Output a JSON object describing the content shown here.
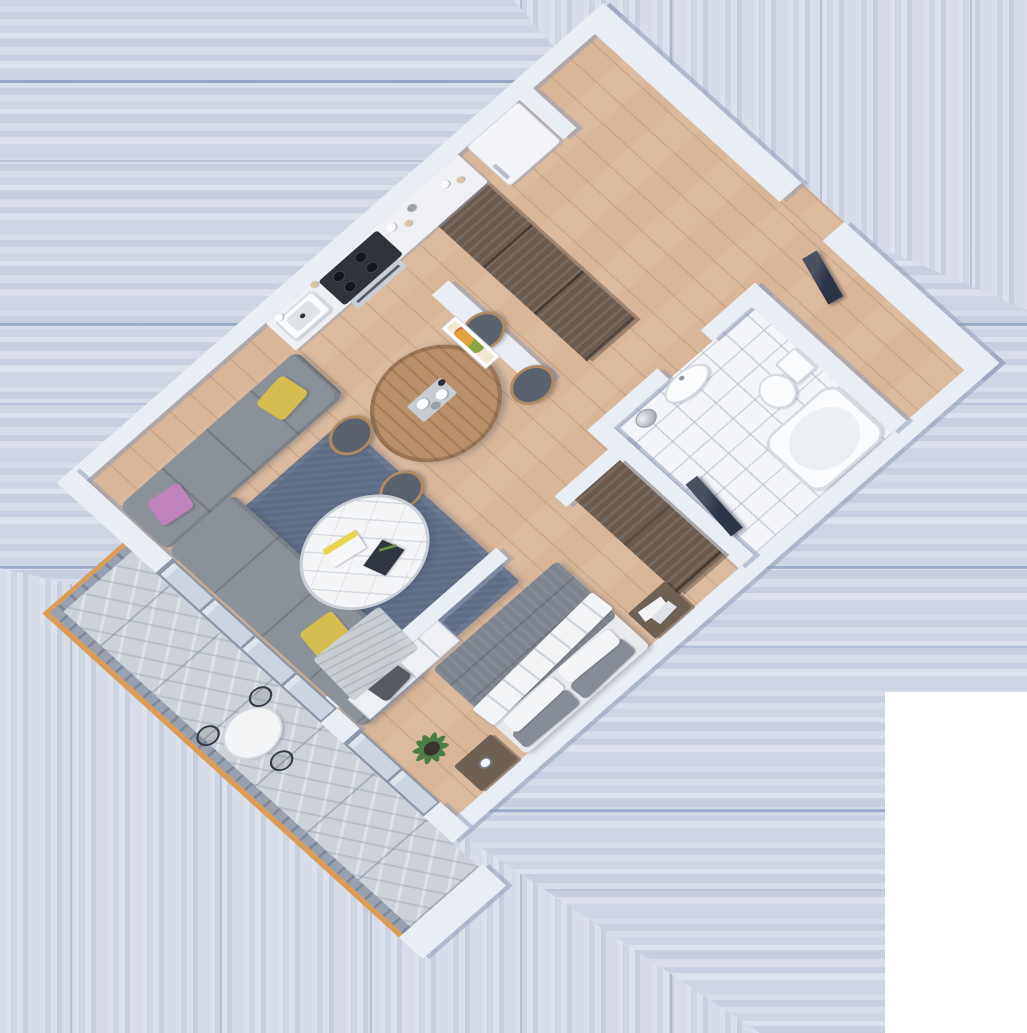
{
  "scene": {
    "label": "3D isometric floor-plan rendering of a one-bedroom apartment with balcony",
    "projection": "isometric render, rotated about 40 degrees",
    "background": "horizontal and vertical pale blue-gray stripe artifact with white bottom-right corner block",
    "visible_text": ""
  },
  "rooms": {
    "kitchen": {
      "label": "Kitchen",
      "items": [
        "counter with sink",
        "gas cooktop",
        "oven front",
        "open shelves with dishes and bottles",
        "white refrigerator with handle",
        "wall niche stub"
      ]
    },
    "dining": {
      "label": "Dining area",
      "items": [
        "oval wooden dining table",
        "4 wood chairs with dark gray cushions",
        "gray table runner with plates and dark bottle",
        "framed colorful artwork on partition wall"
      ]
    },
    "living": {
      "label": "Living room",
      "items": [
        "L-shaped gray sofa",
        "2 yellow pillows",
        "pink pillow",
        "dark gray pillow",
        "white throw blanket",
        "blue-gray area rug",
        "round white marble coffee table",
        "2 magazines",
        "green sprig"
      ]
    },
    "hallway": {
      "label": "Hallway",
      "items": [
        "long dark sliding-door wardrobe",
        "partition wall",
        "dark leaning TV panel",
        "entry opening in northeast wall"
      ]
    },
    "bathroom": {
      "label": "Bathroom",
      "items": [
        "white tiled floor",
        "pedestal sink",
        "toilet with tank",
        "bathtub",
        "chrome waste bin",
        "dark leaning panel"
      ]
    },
    "bedroom": {
      "label": "Bedroom",
      "items": [
        "double bed with gray duvet",
        "folded white sheet",
        "2 gray pillows",
        "2 white pillows",
        "dark wood nightstand with books",
        "dark wood nightstand with coffee cup",
        "dark sliding wardrobe",
        "white low media dresser",
        "potted plant",
        "glass door to balcony"
      ]
    },
    "balcony": {
      "label": "Balcony",
      "items": [
        "gray marble tile floor",
        "railing with wooden handrail",
        "round white bistro table",
        "3 black wire chairs",
        "white end wall block"
      ]
    }
  },
  "colors": {
    "wall": "#e9edf4",
    "wall_shadow": "rgba(146,157,183,0.55)",
    "wood": "#d9b698",
    "wood_seam": "rgba(151,110,78,0.22)",
    "tile": "#f3f5f8",
    "tile_line": "rgba(176,186,202,0.6)",
    "marble": "#cdd2d9",
    "marble_vein": "rgba(130,140,155,0.28)",
    "rug": "#5d6b84",
    "sofa": "#8b9198",
    "sofa_seam": "rgba(60,66,74,0.28)",
    "pillow_yellow": "#d5bd4f",
    "pillow_pink": "#c082bb",
    "pillow_dark": "#565b62",
    "throw": "#cdd2d7",
    "ctable": "#f4f5f7",
    "table_wood": "#b9906a",
    "chair_wood": "#b08a60",
    "cushion": "#5a626d",
    "wardrobe": "#6b5b4f",
    "wardrobe_seam": "rgba(32,25,19,0.5)",
    "white_furn": "#eef0f4",
    "duvet": "#7d838c",
    "sheet": "#f2f4f6",
    "bed_base": "#e8eaee",
    "pillow_gray": "#878d96",
    "pillow_white": "#f4f5f7",
    "nightstand": "#6f6054",
    "navy": "#2b3447",
    "chrome": "#b9c0c9",
    "fixture": "#fbfcfd",
    "fixture_line": "#d6dbe2",
    "rail_cap": "#dd9c55",
    "rail": "#97a1b0",
    "glass": "#ccd5df",
    "glass_frame": "#8a95a6",
    "fridge": "#f3f4f7",
    "counter": "#eef0f4",
    "stove": "#2f343b",
    "burner": "#14171c",
    "plant": "#4e7d46",
    "pot": "#3a332c",
    "stripe_a": "#cdd4e2",
    "stripe_b": "#d7dce8",
    "stripe_c": "#c7cfdf",
    "stripe_d": "#dde1eb",
    "stripe_line": "rgba(104,128,171,0.55)",
    "white_corner": "#ffffff"
  }
}
